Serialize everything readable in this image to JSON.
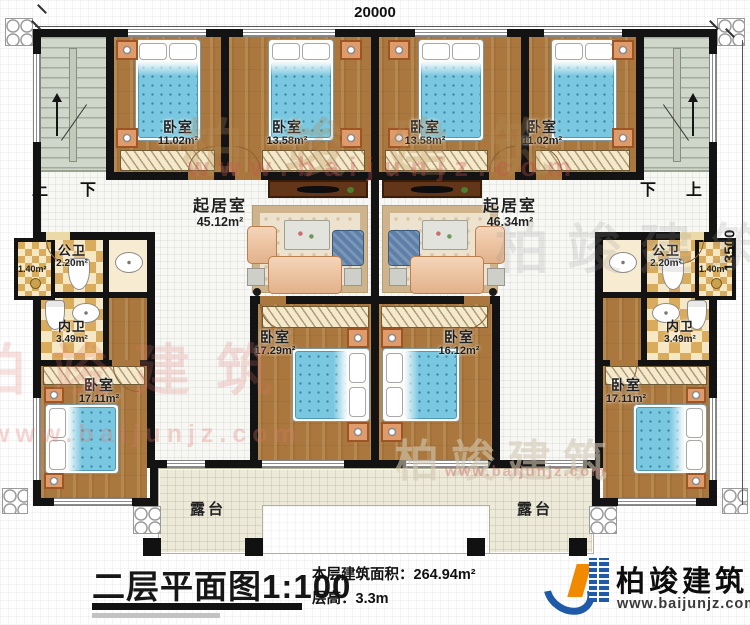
{
  "dimensions": {
    "top": "20000",
    "right": "13500"
  },
  "stairs": {
    "left": {
      "up": "上",
      "down": "下"
    },
    "right": {
      "up": "上",
      "down": "下"
    }
  },
  "rooms": {
    "bedroom_top_left_1": {
      "name": "卧室",
      "area": "11.02m²"
    },
    "bedroom_top_left_2": {
      "name": "卧室",
      "area": "13.58m²"
    },
    "bedroom_top_right_2": {
      "name": "卧室",
      "area": "13.58m²"
    },
    "bedroom_top_right_1": {
      "name": "卧室",
      "area": "11.02m²"
    },
    "living_left": {
      "name": "起居室",
      "area": "45.12m²"
    },
    "living_right": {
      "name": "起居室",
      "area": "46.34m²"
    },
    "public_bath_left": {
      "name": "公卫",
      "area": "2.20m²"
    },
    "public_bath_right": {
      "name": "公卫",
      "area": "2.20m²"
    },
    "ledge_left": {
      "area": "1.40m²"
    },
    "ledge_right": {
      "area": "1.40m²"
    },
    "private_bath_left": {
      "name": "内卫",
      "area": "3.49m²"
    },
    "private_bath_right": {
      "name": "内卫",
      "area": "3.49m²"
    },
    "bedroom_bottom_left": {
      "name": "卧室",
      "area": "17.11m²"
    },
    "bedroom_bottom_center_left": {
      "name": "卧室",
      "area": "17.29m²"
    },
    "bedroom_bottom_center_right": {
      "name": "卧室",
      "area": "16.12m²"
    },
    "bedroom_bottom_right": {
      "name": "卧室",
      "area": "17.11m²"
    },
    "terrace_left": {
      "name": "露台"
    },
    "terrace_right": {
      "name": "露台"
    }
  },
  "title_block": {
    "plan_title": "二层平面图",
    "scale": "1:100",
    "area_label": "本层建筑面积：",
    "area_value": "264.94m²",
    "floor_height_label": "层高：",
    "floor_height_value": "3.3m"
  },
  "brand": {
    "name": "柏竣建筑",
    "url": "www.baijunjz.com"
  },
  "watermark": {
    "name": "柏竣建筑",
    "url": "www.baijunjz.com"
  }
}
